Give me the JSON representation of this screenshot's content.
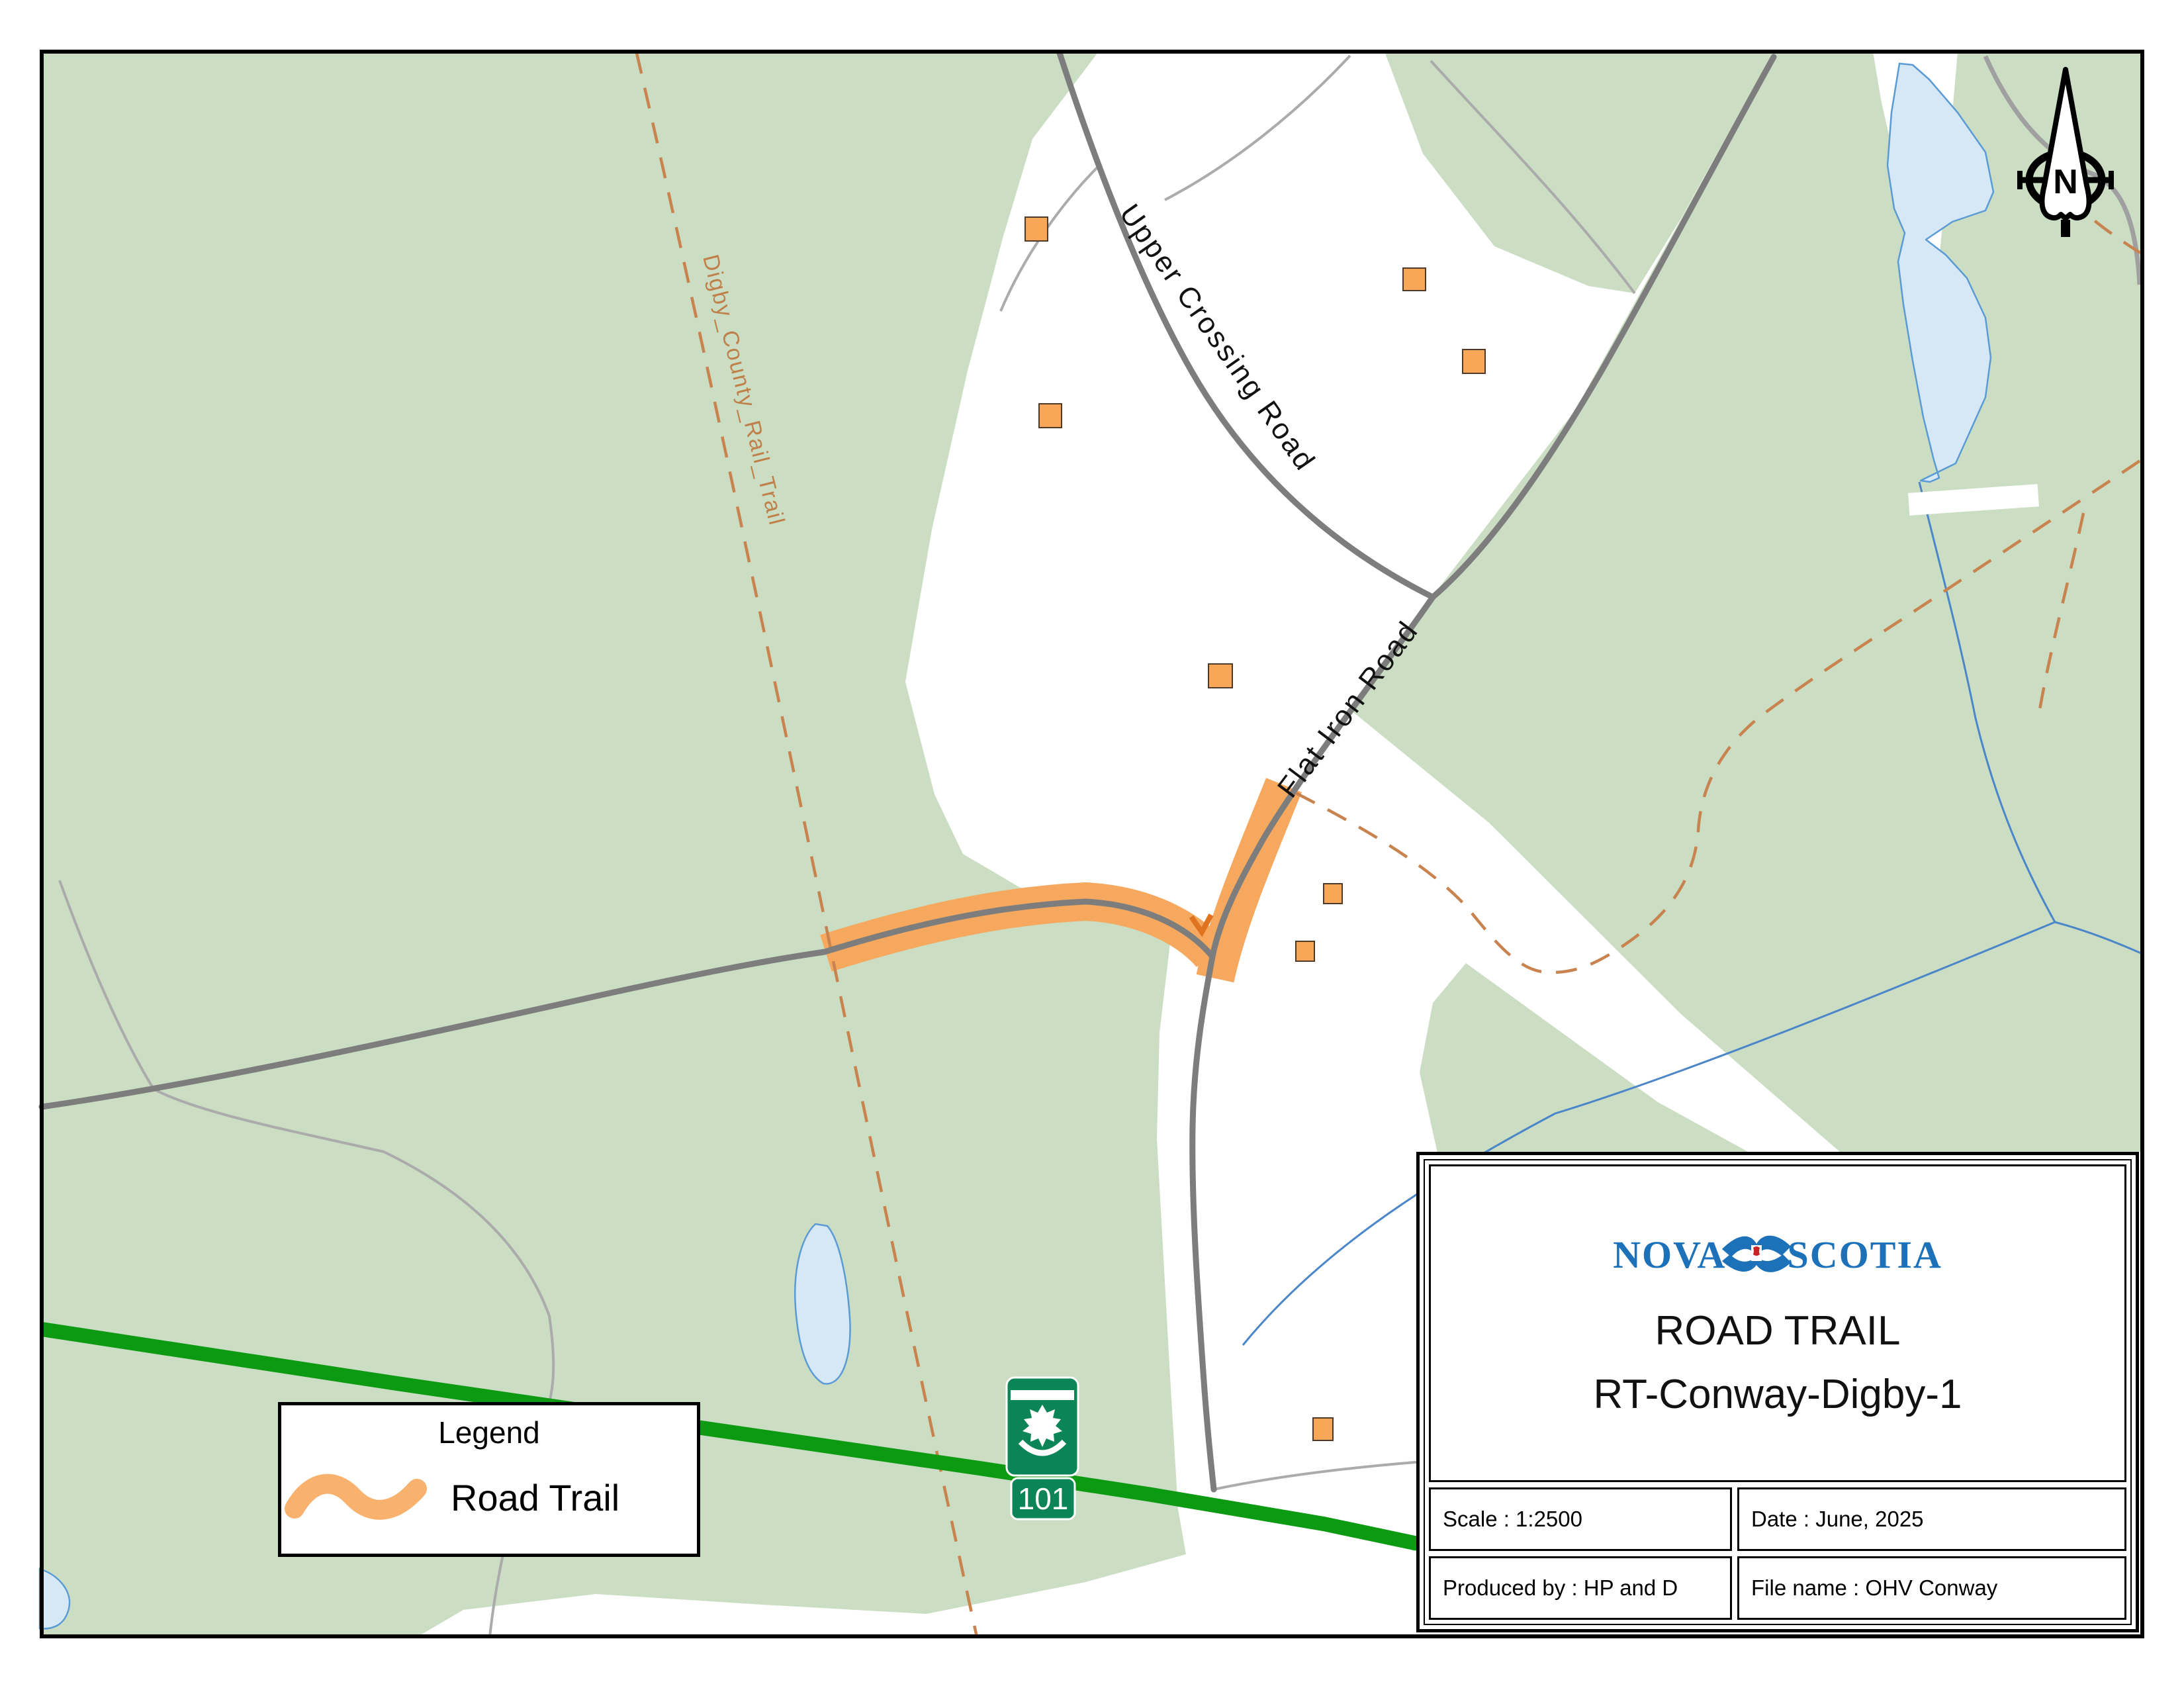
{
  "map": {
    "labels": {
      "upper_crossing_road": "Upper Crossing Road",
      "flat_iron_road": "Flat Iron Road",
      "rail_trail": "Digby_County_Rail_Trail"
    },
    "shield": {
      "route": "101"
    },
    "compass": {
      "letter": "N",
      "icon": "north-arrow-icon"
    },
    "colors": {
      "forest_green": "#cbdec4",
      "water_fill": "#d6e8f6",
      "water_line": "#5b9bd5",
      "road_gray": "#7d7d7d",
      "minor_road_gray": "#ababab",
      "trail_orange": "#f5a85e",
      "rail_trail_tan": "#c8834f",
      "highway_green": "#0c9a12",
      "shield_green": "#0b8457",
      "building_orange": "#f7a757"
    }
  },
  "legend": {
    "title": "Legend",
    "items": [
      {
        "label": "Road Trail",
        "symbol": "road-trail-swoosh-icon",
        "color": "#f5a85e"
      }
    ]
  },
  "title_block": {
    "org_left": "NOVA",
    "org_right": "SCOTIA",
    "org_flag": "nova-scotia-flag-icon",
    "title_line1": "ROAD TRAIL",
    "title_line2": "RT-Conway-Digby-1",
    "scale": "Scale : 1:2500",
    "date": "Date : June, 2025",
    "produced_by": "Produced by : HP and D",
    "file_name": "File name : OHV Conway"
  }
}
